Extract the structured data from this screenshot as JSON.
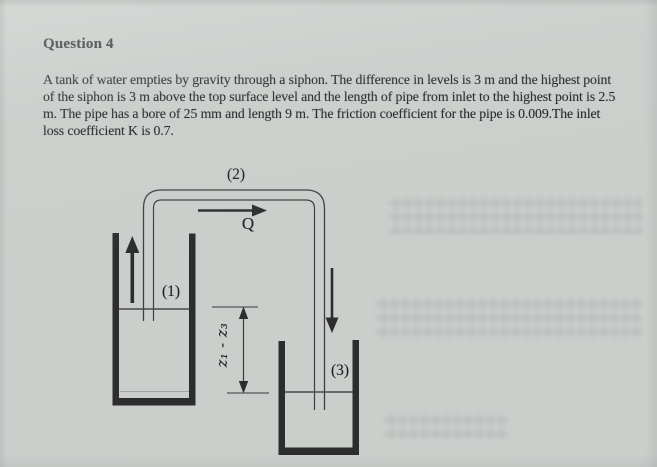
{
  "document": {
    "title": "Question 4",
    "paragraph_lines": [
      "A tank of water empties by gravity through a siphon. The difference in levels is 3 m and the highest point",
      "of the siphon is 3 m above the top surface level and the length of pipe from inlet to the highest point is 2.5",
      "m. The pipe has a bore of 25 mm and length 9 m. The friction coefficient for the pipe is 0.009.The inlet",
      "loss coefficient K is 0.7."
    ]
  },
  "diagram": {
    "labels": {
      "point1": "(1)",
      "point2": "(2)",
      "point3": "(3)",
      "flow": "Q",
      "height_difference": "z₁ - z₃"
    },
    "colors": {
      "paper": "#cbcfcc",
      "ink": "#1b1b1b",
      "line_art": "#3e3e3e",
      "tank_wall": "#2d2d2d"
    }
  }
}
